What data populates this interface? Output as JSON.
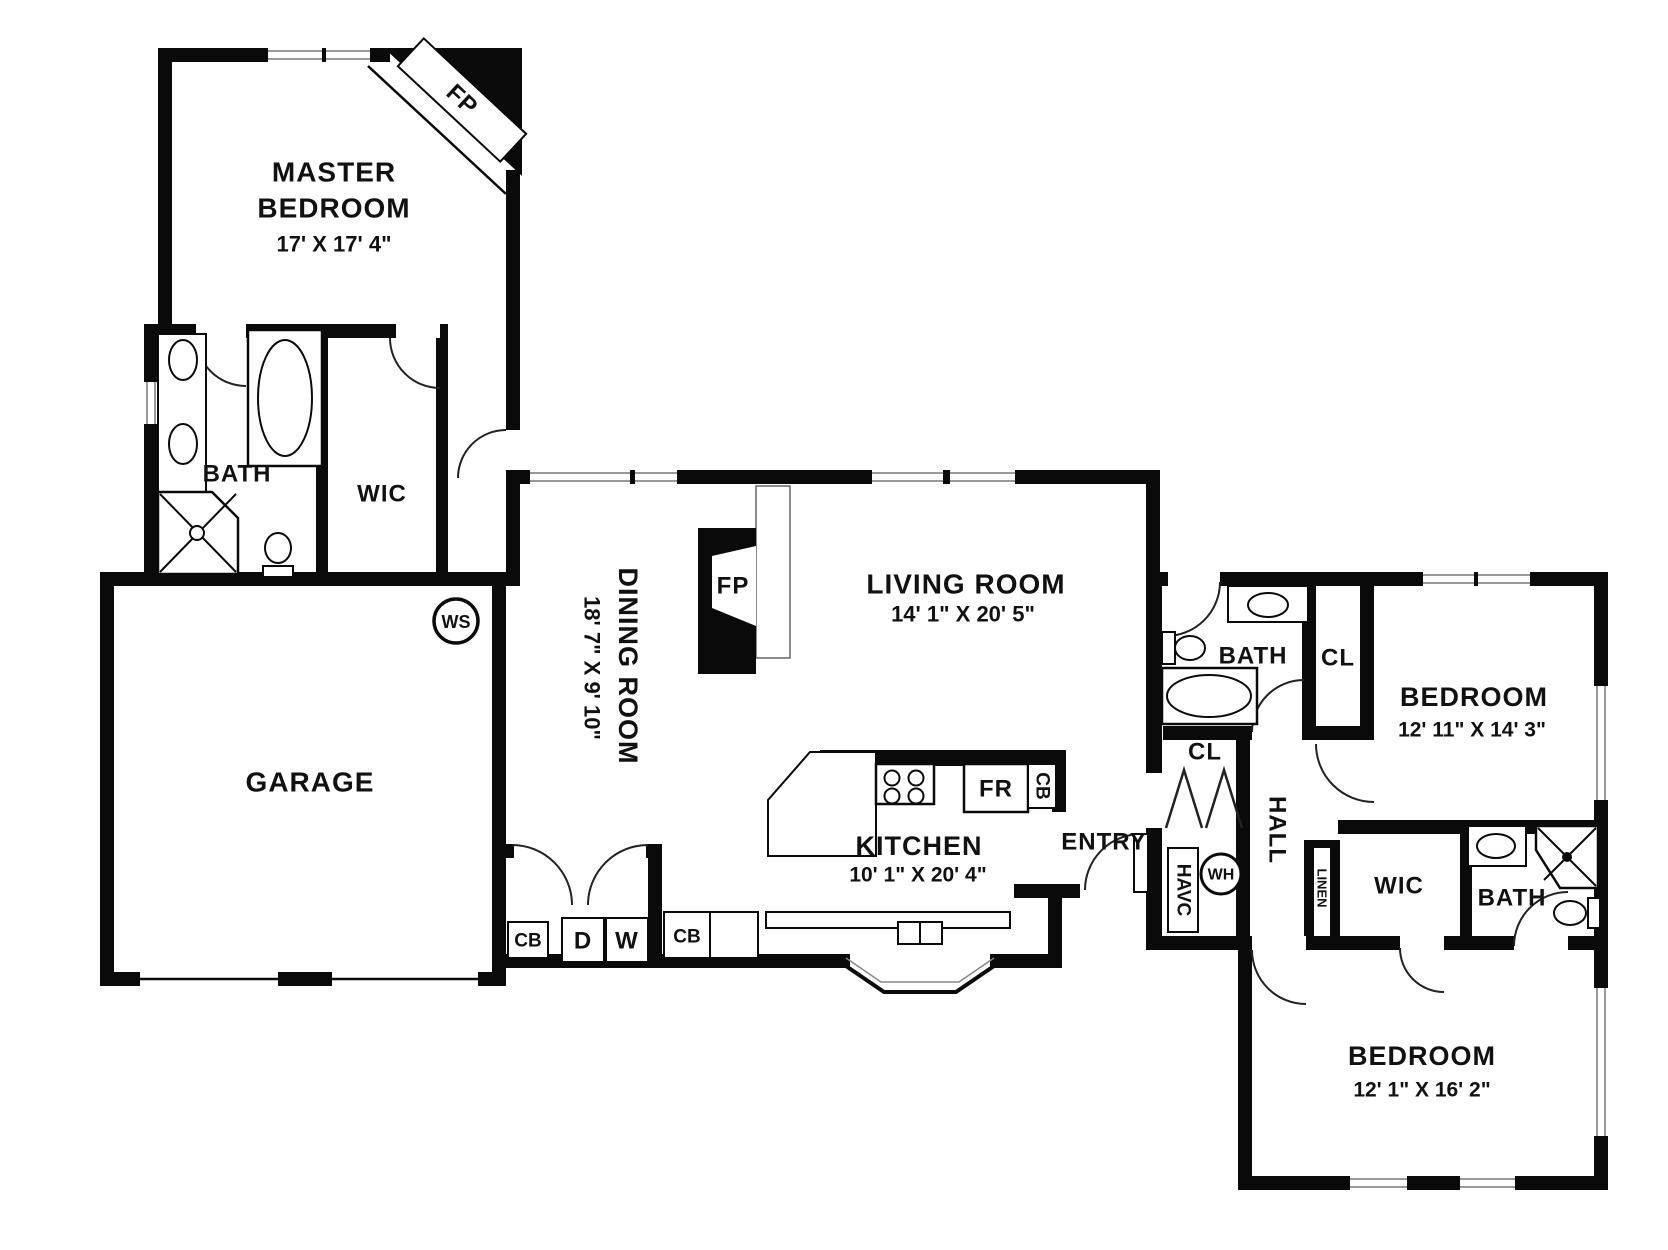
{
  "rooms": {
    "master_bedroom": {
      "line1": "MASTER",
      "line2": "BEDROOM",
      "dims": "17' X 17' 4\""
    },
    "master_bath": {
      "label": "BATH"
    },
    "master_wic": {
      "label": "WIC"
    },
    "garage": {
      "label": "GARAGE"
    },
    "dining_room": {
      "label": "DINING ROOM",
      "dims": "18' 7\" X 9' 10\""
    },
    "living_room": {
      "label": "LIVING ROOM",
      "dims": "14' 1\" X 20' 5\""
    },
    "kitchen": {
      "label": "KITCHEN",
      "dims": "10' 1\" X 20' 4\""
    },
    "entry": {
      "label": "ENTRY"
    },
    "hall": {
      "label": "HALL"
    },
    "bath_2": {
      "label": "BATH"
    },
    "closet_2": {
      "label": "CL"
    },
    "bedroom_2": {
      "label": "BEDROOM",
      "dims": "12' 11\" X 14' 3\""
    },
    "hall_closet": {
      "label": "CL"
    },
    "linen": {
      "label": "LINEN"
    },
    "wic_2": {
      "label": "WIC"
    },
    "bath_3": {
      "label": "BATH"
    },
    "bedroom_3": {
      "label": "BEDROOM",
      "dims": "12' 1\" X 16' 2\""
    }
  },
  "fixtures": {
    "fireplace_master": "FP",
    "fireplace_living": "FP",
    "water_softener": "WS",
    "water_heater": "WH",
    "hvac": "HAVC",
    "fridge": "FR",
    "cabinet_kitchen": "CB",
    "cabinet_laundry_left": "CB",
    "cabinet_laundry_right": "CB",
    "dryer": "D",
    "washer": "W"
  }
}
